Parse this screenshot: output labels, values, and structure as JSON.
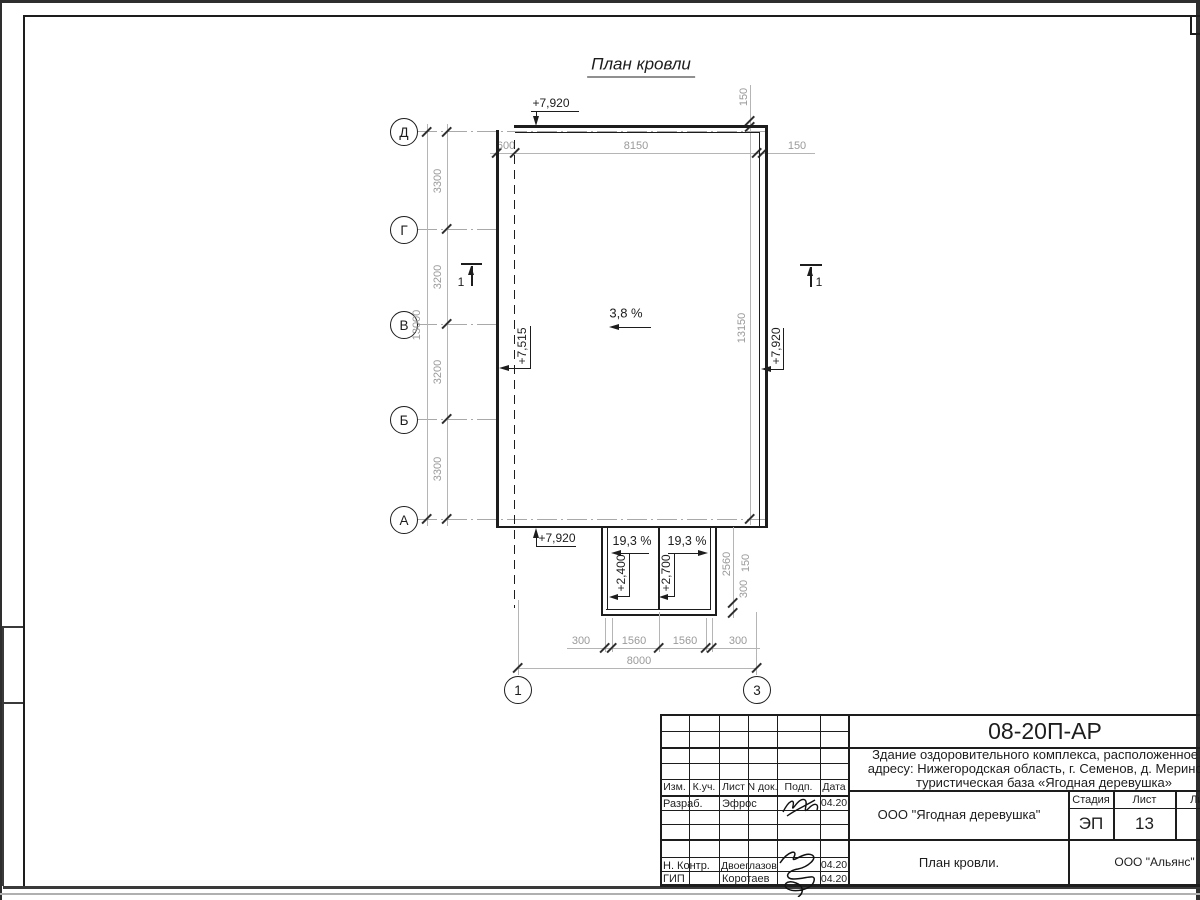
{
  "drawing": {
    "title": "План кровли",
    "slope": "3,8 %",
    "elev_top": "+7,920",
    "elev_left": "+7,515",
    "elev_right": "+7,920",
    "elev_bottom": "+7,920",
    "axes_rows": [
      "Д",
      "Г",
      "В",
      "Б",
      "А"
    ],
    "axes_cols": [
      "1",
      "3"
    ],
    "dim_left_total": "13000",
    "dims_left": [
      "3300",
      "3200",
      "3200",
      "3300"
    ],
    "dims_top": [
      "600",
      "8150",
      "150"
    ],
    "dim_right_offset": "150",
    "dim_right_total": "13150",
    "section_mark": "1",
    "canopy": {
      "slope_left": "19,3 %",
      "slope_right": "19,3 %",
      "elev_left": "+2,400",
      "elev_right": "+2,700",
      "dim_height": "2560",
      "dim_offset": "150",
      "dim_edge": "300"
    },
    "dims_bottom": [
      "300",
      "1560",
      "1560",
      "300"
    ],
    "dim_bottom_total": "8000"
  },
  "titleblock": {
    "doc_number": "08-20П-АР",
    "project_line1": "Здание оздоровительного комплекса, расположенное по",
    "project_line2": "адресу: Нижегородская область, г. Семенов, д. Мериново,",
    "project_line3": "туристическая база «Ягодная деревушка»",
    "organization": "ООО \"Ягодная деревушка\"",
    "drawing_name": "План кровли.",
    "company": "ООО \"Альянс\"",
    "stage_label": "Стадия",
    "sheet_label": "Лист",
    "sheets_label": "Листов",
    "stage_value": "ЭП",
    "sheet_value": "13",
    "header": [
      "Изм.",
      "К.уч.",
      "Лист",
      "N док.",
      "Подп.",
      "Дата"
    ],
    "rows": [
      {
        "role": "Разраб.",
        "name": "Эфрос",
        "date": "04.20"
      },
      {
        "role": "Н. Контр.",
        "name": "Двоеглазов",
        "date": "04.20"
      },
      {
        "role": "ГИП",
        "name": "Коротаев",
        "date": "04.20"
      }
    ]
  }
}
